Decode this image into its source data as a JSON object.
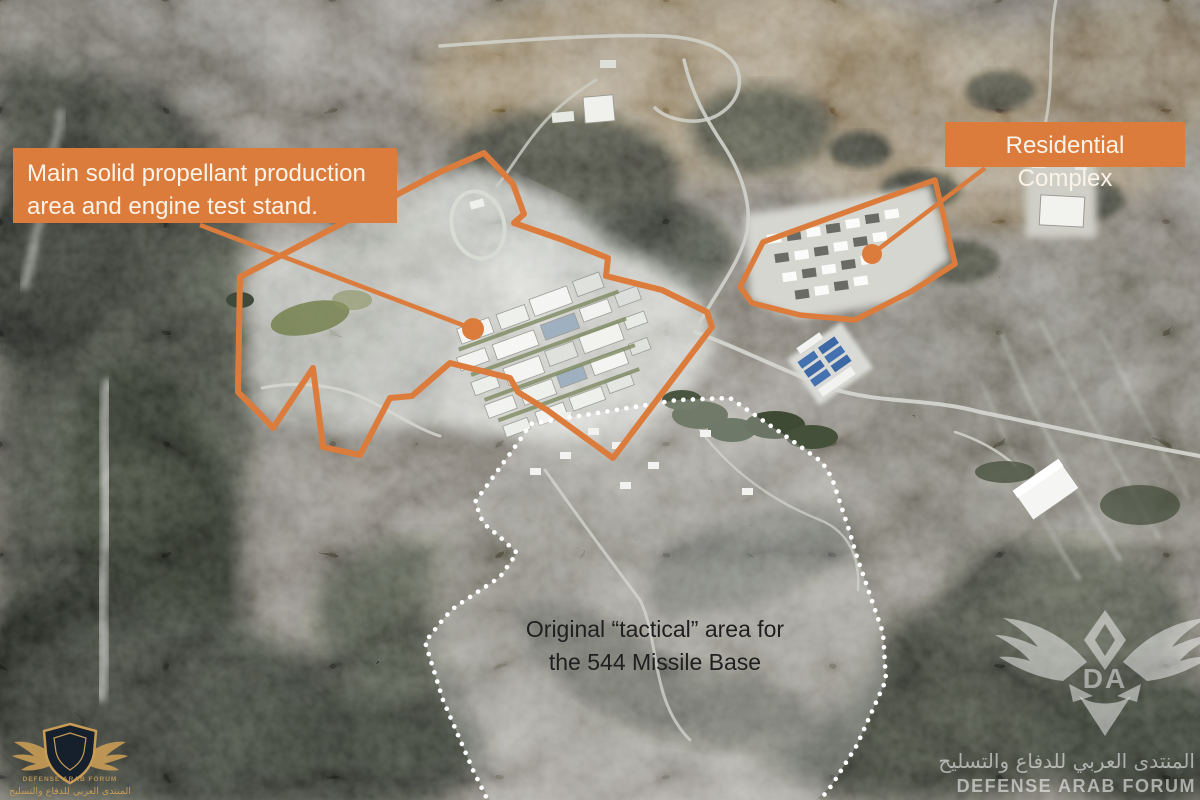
{
  "image": {
    "width": 1200,
    "height": 800,
    "kind": "annotated satellite photograph"
  },
  "colors": {
    "annotation_orange": "#dc7c3c",
    "callout_text": "#fbf3e8",
    "tactical_text": "#1f1f1f",
    "dotted_outline": "#ffffff",
    "watermark_white": "rgba(255,255,255,0.5)",
    "watermark_gold": "#c89c55"
  },
  "labels": {
    "production": {
      "line1": "Main solid propellant production",
      "line2": "area and engine test stand."
    },
    "residential": {
      "text": "Residential Complex"
    },
    "tactical": {
      "line1": "Original “tactical” area for",
      "line2": "the 544 Missile Base"
    }
  },
  "watermarks": {
    "defense_arab": {
      "initials": "DA",
      "arabic": "المنتدى العربي للدفاع والتسليح",
      "english": "DEFENSE ARAB FORUM"
    },
    "corner_logo": {
      "english_small": "DEFENSE ARAB FORUM",
      "arabic": "المنتدى العربي للدفاع والتسليح"
    }
  }
}
